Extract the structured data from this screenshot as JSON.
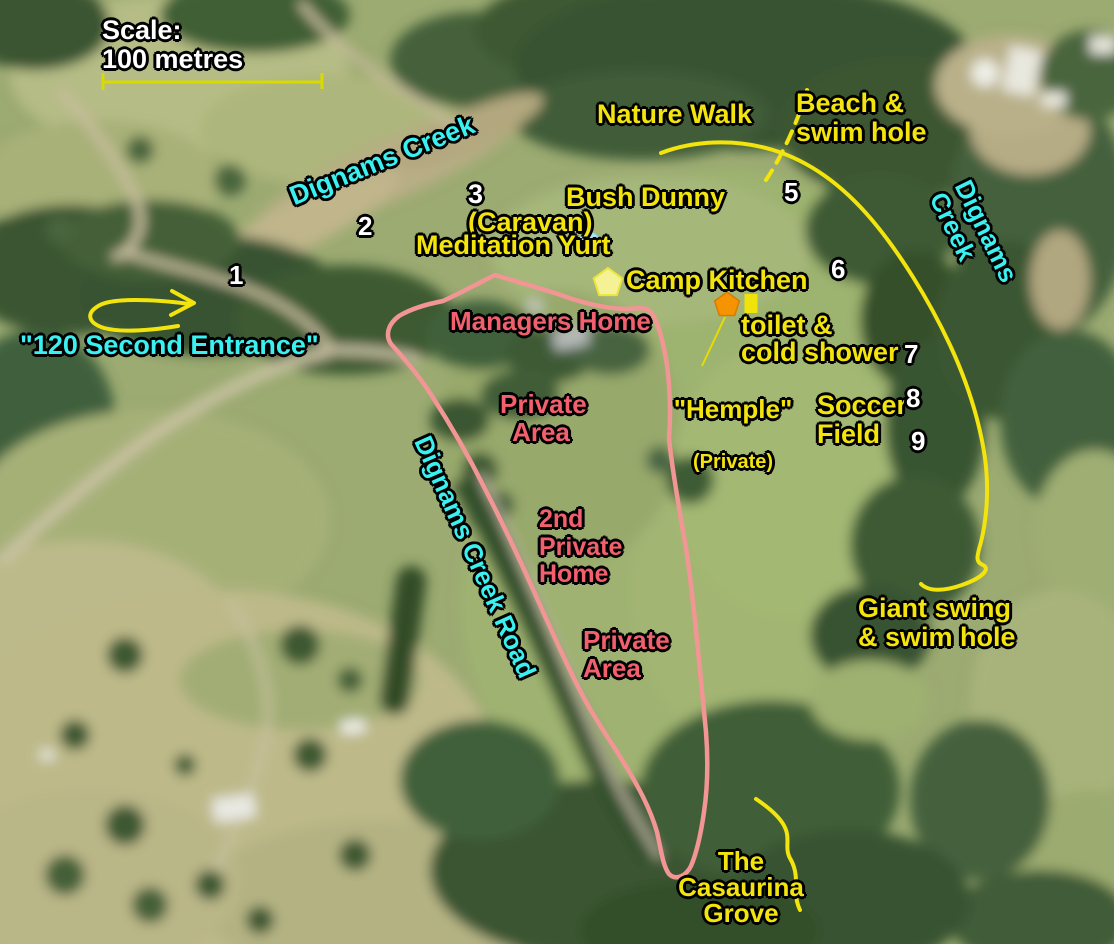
{
  "scale": {
    "label": "Scale:\n100 metres"
  },
  "waterways": {
    "creek_upper_label": "Dignams Creek",
    "creek_right_label": "Dignams Creek"
  },
  "roads": {
    "creek_road_label": "Dignams Creek Road",
    "entrance_label": "\"120 Second Entrance\""
  },
  "sites": {
    "n1": "1",
    "n2": "2",
    "n3": "3",
    "n3_suffix": "(Caravan)",
    "n5": "5",
    "n6": "6",
    "n7": "7",
    "n8": "8",
    "n9": "9"
  },
  "facilities": {
    "nature_walk": "Nature Walk",
    "beach_swim_hole": "Beach &\nswim hole",
    "bush_dunny": "Bush Dunny",
    "meditation_yurt": "Meditation Yurt",
    "camp_kitchen": "Camp Kitchen",
    "toilet_cold_shower": "toilet &\ncold shower",
    "hemple": "\"Hemple\"",
    "hemple_note": "(Private)",
    "soccer_field": "Soccer\nField",
    "giant_swing_swim_hole": "Giant swing\n& swim hole",
    "casaurina_grove": "The\nCasaurina\nGrove"
  },
  "private_zones": {
    "managers_home": "Managers Home",
    "private_area_upper": "Private\nArea",
    "second_private_home": "2nd\nPrivate\nHome",
    "private_area_lower": "Private\nArea"
  },
  "legend_colors": {
    "facility_label_yellow": "#f2e40c",
    "water_label_cyan": "#3af0f0",
    "private_label_pink": "#f2606e",
    "private_boundary_pink": "#f29595",
    "site_number_white": "#ffffff",
    "path_line_yellow": "#f2e40c",
    "scale_bar_yellow": "#d9da00",
    "toilet_marker_orange": "#f59300",
    "kitchen_marker_pale_yellow": "#f5f195",
    "shower_marker_yellow": "#f0e30a",
    "yurt_marker_light_blue": "#abe3f2"
  }
}
